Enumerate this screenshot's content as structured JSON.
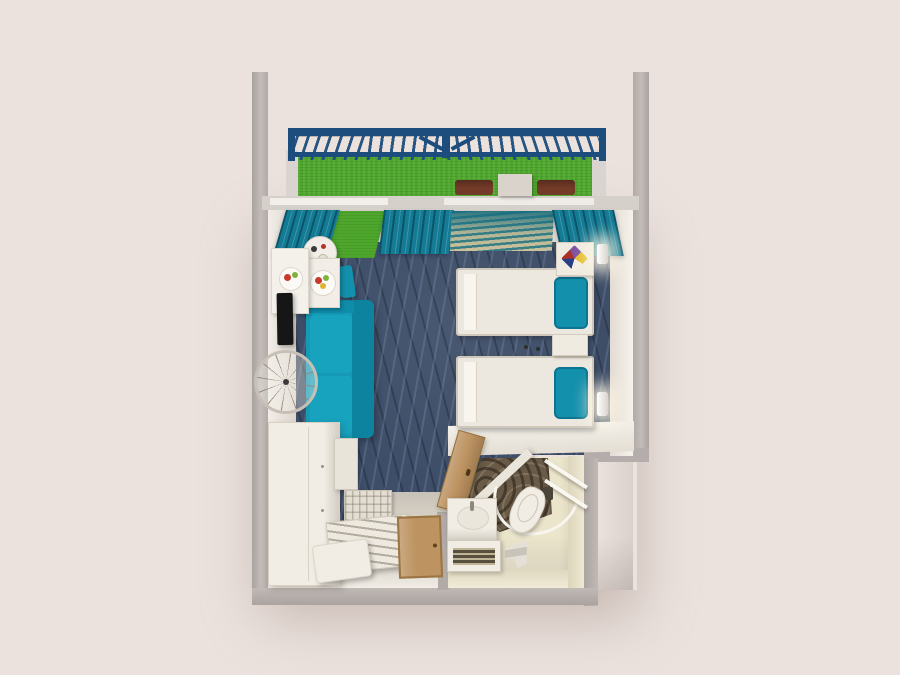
{
  "meta": {
    "label": "3D top-down floor plan render of a hotel studio room with balcony",
    "view": "top-down 3d render",
    "canvas": {
      "width": 900,
      "height": 675
    }
  },
  "palette": {
    "background": "#ebe2de",
    "wall_outer": "#b1aaa6",
    "wall_face": "#f2ede7",
    "turf_green": "#4ea72c",
    "railing_navy": "#1d4d7d",
    "curtain_teal": "#147b95",
    "sheer_base": "#cdc29a",
    "carpet_navy": "#3e4e68",
    "sofa_teal": "#1599b4",
    "accent_teal": "#1390ac",
    "bed_linen": "#ece7df",
    "nightstand_white": "#f0ebe1",
    "door_tan": "#bd9361",
    "entry_floor": "#d8d2c7",
    "bathroom_floor": "#ebe5cc",
    "shower_floor": "#6a5b48",
    "fixture_white": "#f1ede4",
    "tv_black": "#161616",
    "chair_brown": "#733a27",
    "bench_slats": "#eee9df",
    "towel_yellow": "#e3bf2e",
    "towel_navy": "#2a3d85",
    "towel_red": "#ac3129",
    "towel_purple": "#7b52a0",
    "fruit_red": "#c83a2d",
    "fruit_green": "#7fb13f",
    "fruit_yellow": "#ddb32f"
  },
  "rooms": [
    {
      "id": "balcony",
      "label": "Balcony",
      "objects": [
        "navy railing",
        "artificial turf floor",
        "two lounge chairs",
        "side table"
      ]
    },
    {
      "id": "bedroom",
      "label": "Bedroom / Living Area",
      "objects": [
        "twin bed",
        "twin bed",
        "nightstand",
        "corner nightstand with folded towels",
        "two wall lamps",
        "teal sofa",
        "round table",
        "square table with fruit plate",
        "wall tray with fruit plate",
        "teal dining chair",
        "TV",
        "wall clock",
        "teal curtains",
        "sheer patterned curtain",
        "green mat",
        "navy wave-pattern carpet"
      ]
    },
    {
      "id": "entry",
      "label": "Entry",
      "objects": [
        "entrance door",
        "wardrobe",
        "minibar cabinet",
        "grid-top cabinet",
        "slatted luggage bench",
        "ottoman"
      ]
    },
    {
      "id": "bathroom",
      "label": "Bathroom",
      "objects": [
        "open bathroom door",
        "shower area",
        "curved shower rail",
        "toilet",
        "vanity sink",
        "towel shelf unit",
        "glass shelves",
        "floor towel",
        "waste bin"
      ]
    }
  ]
}
